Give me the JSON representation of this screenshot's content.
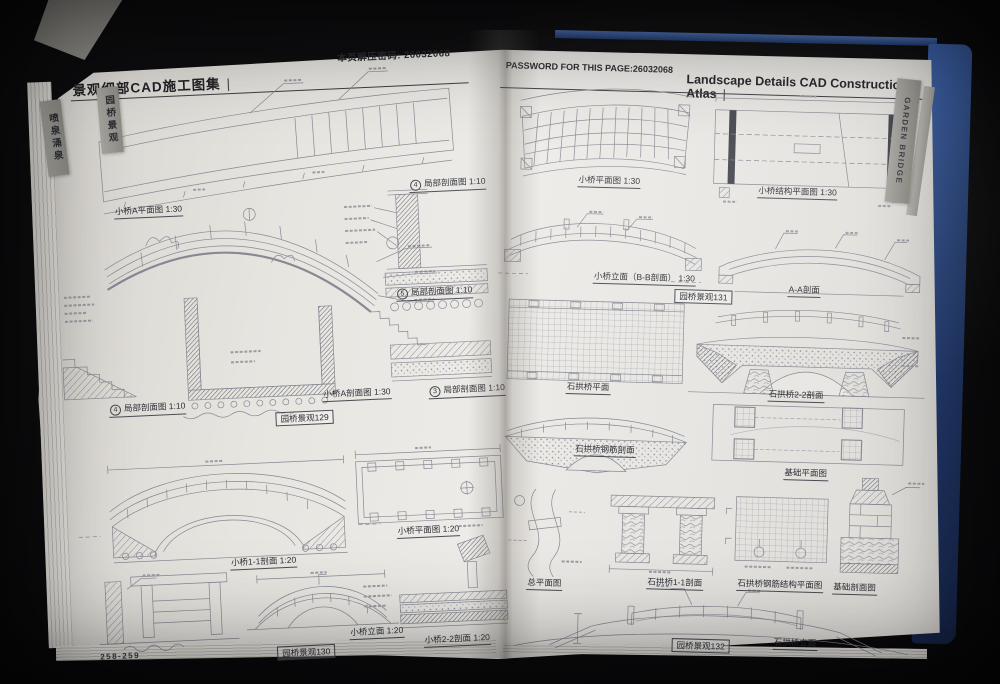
{
  "colors": {
    "cover_blue": "#2c4d8f",
    "page": "#e8e6e1",
    "tab_gray": "#97958e",
    "ink": "#2a2b30",
    "cad_line": "#878893"
  },
  "left_page": {
    "header": {
      "title": "景观细部CAD施工图集",
      "bar": "|",
      "password_note": "本页解压密码: 26032068"
    },
    "tabs": [
      {
        "label": "喷泉涌泉"
      },
      {
        "label": "园桥景观"
      }
    ],
    "page_number": "258-259",
    "captions": [
      {
        "text": "小桥A平面图 1:30"
      },
      {
        "num": "4",
        "text": "局部剖面图 1:10"
      },
      {
        "num": "5",
        "text": "局部剖面图 1:10"
      },
      {
        "num": "4",
        "text": "局部剖面图 1:10"
      },
      {
        "text": "小桥A剖面图 1:30"
      },
      {
        "num": "3",
        "text": "局部剖面图 1:10"
      },
      {
        "text": "园桥景观129"
      },
      {
        "text": "小桥平面图 1:20"
      },
      {
        "text": "小桥1-1剖面 1:20"
      },
      {
        "text": "小桥立面 1:20"
      },
      {
        "text": "园桥景观130"
      },
      {
        "text": "小桥2-2剖面 1:20"
      }
    ]
  },
  "right_page": {
    "header": {
      "password_note": "PASSWORD FOR THIS PAGE:26032068",
      "title": "Landscape Details CAD Construction Atlas",
      "bar": "|"
    },
    "tab": {
      "label": "GARDEN BRIDGE"
    },
    "captions": [
      {
        "text": "小桥平面图 1:30"
      },
      {
        "text": "小桥结构平面图 1:30"
      },
      {
        "text": "小桥立面（B-B剖面） 1:30"
      },
      {
        "text": "A-A剖面"
      },
      {
        "text": "园桥景观131"
      },
      {
        "text": "石拱桥平面"
      },
      {
        "text": "石拱桥2-2剖面"
      },
      {
        "text": "石拱桥钢筋剖面"
      },
      {
        "text": "基础平面图"
      },
      {
        "text": "总平面图"
      },
      {
        "text": "石拱桥1-1剖面"
      },
      {
        "text": "石拱桥钢筋结构平面图"
      },
      {
        "text": "基础剖面图"
      },
      {
        "text": "园桥景观132"
      },
      {
        "text": "石拱桥立面"
      }
    ]
  }
}
